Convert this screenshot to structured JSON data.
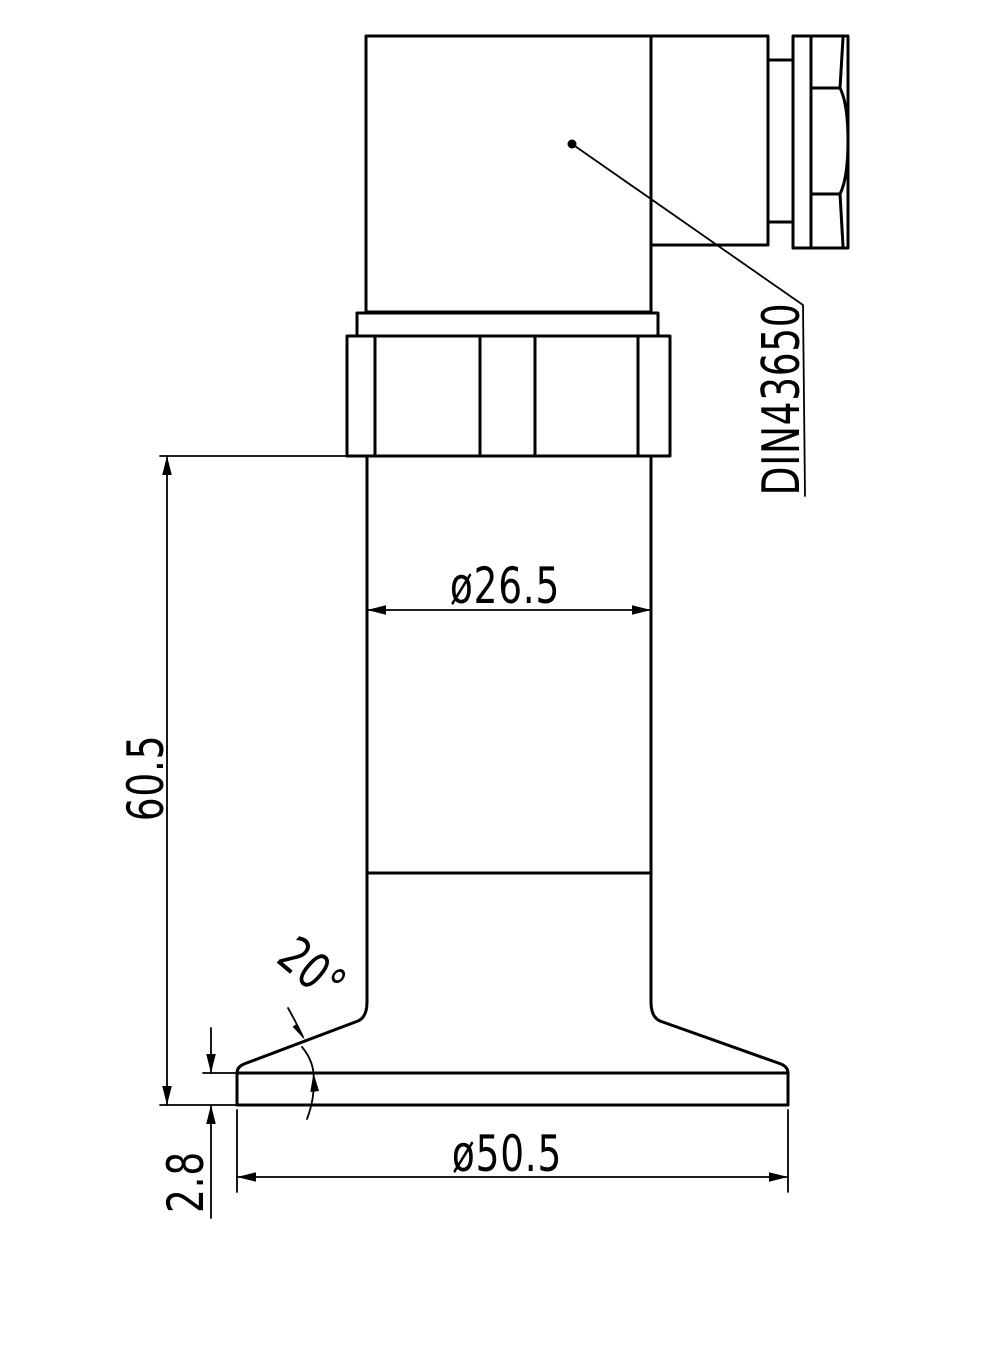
{
  "drawing": {
    "type": "engineering-dimension-drawing",
    "subject": "pressure-transmitter-with-clamp-ferrule",
    "colors": {
      "background": "#ffffff",
      "line": "#000000"
    },
    "labels": {
      "connector_standard": "DIN43650",
      "body_diameter": "ø26.5",
      "overall_height": "60.5",
      "rim_thickness": "2.8",
      "clamp_diameter": "ø50.5",
      "flare_angle": "20°"
    }
  }
}
